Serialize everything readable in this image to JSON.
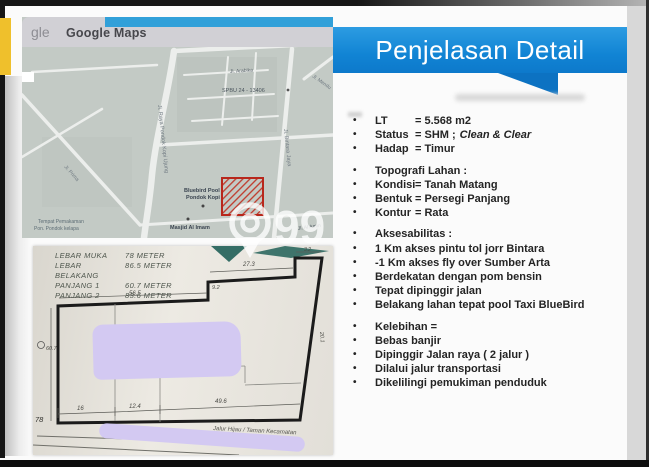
{
  "slide": {
    "title": "Penjelasan Detail"
  },
  "map_panel": {
    "logo_fragment": "gle",
    "header_title": "Google Maps",
    "labels": {
      "street_top": "Jl. Arabika",
      "spbu": "SPBU 24 - 13406",
      "pool_line1": "Bluebird Pool",
      "pool_line2": "Pondok Kopi",
      "mosque": "Masjid Al Imam",
      "cemetery_line1": "Tempat Pemakaman",
      "cemetery_line2": "Pon. Pondok kelapa",
      "road_main": "Jl. Raya Pondok Kopi Ujung",
      "road_right": "Jl. Bintara Jaya",
      "road_topright": "Jl. Mendu",
      "road_left": "Jl. Prima",
      "road_bottomright": "Jl. Al Amin"
    }
  },
  "sketch_panel": {
    "notes": [
      {
        "label": "LEBAR MUKA",
        "value": "78  METER"
      },
      {
        "label": "LEBAR BELAKANG",
        "value": "86.5 METER"
      },
      {
        "label": "PANJANG 1",
        "value": "60.7 METER"
      },
      {
        "label": "PANJANG 2",
        "value": "83.6 METER"
      }
    ],
    "dims": {
      "top": "56.5",
      "step_right": "27.3",
      "step_height": "9.2",
      "top_right": "3.2",
      "right_side": "20.1",
      "left_side": "60.7",
      "front_left": "78",
      "bottom_1": "16",
      "bottom_2": "12.4",
      "bottom_3": "49.6"
    },
    "road_label": "Jalur Hijau / Taman Kecamatan"
  },
  "details": {
    "groups": [
      {
        "rows": [
          {
            "k": "LT",
            "v": "= 5.568 m2"
          },
          {
            "k": "Status",
            "v": "= SHM ;",
            "vi": "Clean & Clear"
          },
          {
            "k": "Hadap",
            "v": "= Timur"
          }
        ]
      },
      {
        "rows": [
          {
            "t": "Topografi Lahan :"
          },
          {
            "k": "Kondisi",
            "v": "= Tanah Matang"
          },
          {
            "k": "Bentuk",
            "v": "= Persegi Panjang"
          },
          {
            "k": "Kontur",
            "v": "= Rata"
          }
        ]
      },
      {
        "rows": [
          {
            "t": "Aksesabilitas :"
          },
          {
            "t": "1 Km akses pintu tol jorr Bintara"
          },
          {
            "t": "-1 Km akses fly over Sumber Arta"
          },
          {
            "t": "Berdekatan dengan pom bensin"
          },
          {
            "t": "Tepat dipinggir jalan"
          },
          {
            "t": "Belakang lahan tepat pool Taxi BlueBird"
          }
        ]
      },
      {
        "rows": [
          {
            "t": "Kelebihan ="
          },
          {
            "t": "Bebas banjir"
          },
          {
            "t": "Dipinggir Jalan raya  ( 2 jalur )"
          },
          {
            "t": "Dilalui jalur transportasi"
          },
          {
            "t": "Dikelilingi pemukiman penduduk"
          }
        ]
      }
    ]
  },
  "watermark": {
    "number": "99"
  },
  "colors": {
    "banner_blue": "#1184d4",
    "banner_tail": "#0c72c2",
    "yellow_bar": "#efc02c",
    "redaction_lavender": "#d3c9f2",
    "marker_red": "#c0392b",
    "map_bg": "#c3cac5"
  }
}
